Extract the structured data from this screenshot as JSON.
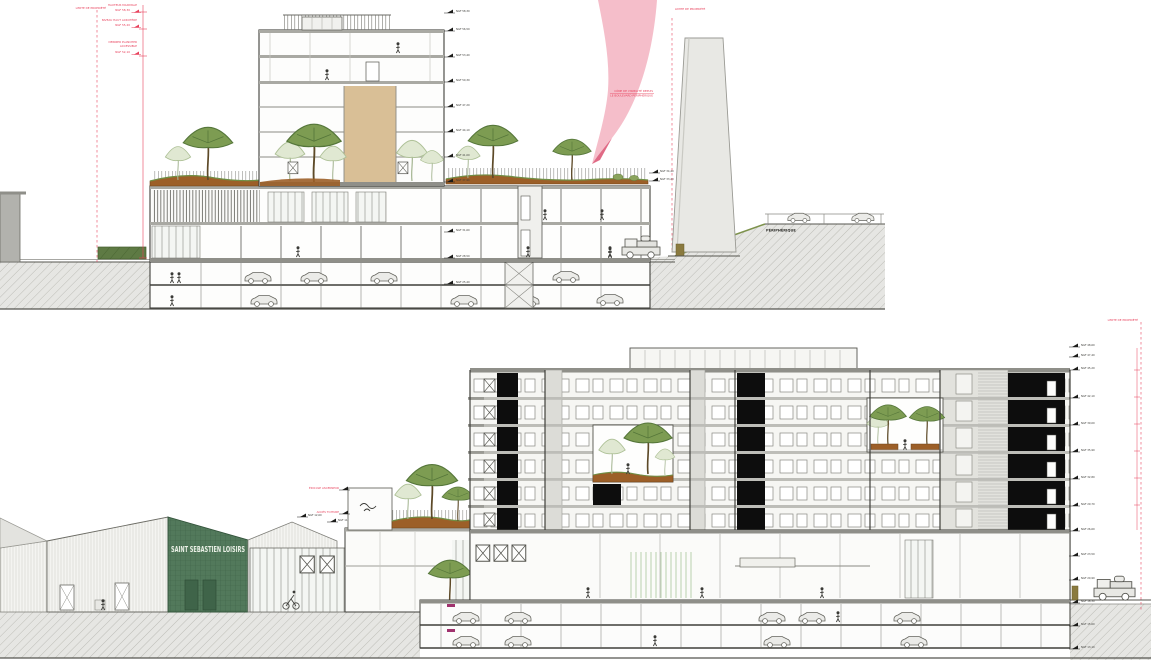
{
  "top": {
    "limit_left": "LIMITE DE PROPRIÉTÉ",
    "limit_right": "LIMITE DE PROPRIÉTÉ",
    "ann": [
      {
        "l1": "HAUTEUR MAXIMALE",
        "v": "NGF 58,30"
      },
      {
        "l1": "NIVEAU HAUT ACROTÈRE",
        "v": "NGF 55,20"
      },
      {
        "l1": "DERNIER PLANCHER",
        "l2": "ACCESSIBLE",
        "v": "NGF 52,10"
      }
    ],
    "ribbon1": "CÔNE DE VISIBILITÉ DEPUIS",
    "ribbon2": "LE BOULEVARD PÉRIPHÉRIQUE",
    "road": "PÉRIPHÉRIQUE",
    "levels": [
      "NGF 58,30",
      "NGF 56,50",
      "NGF 53,40",
      "NGF 50,30",
      "NGF 47,20",
      "NGF 44,10",
      "NGF 41,00",
      "NGF 37,90",
      "NGF 31,60",
      "NGF 28,50",
      "NGF 25,40"
    ],
    "roof_flags": [
      "NGF 34,40",
      "NGF 33,20"
    ]
  },
  "bottom": {
    "sign": "SAINT SEBASTIEN LOISIRS",
    "notes": [
      "ÉDICULE ASCENSEUR",
      "ACCÈS TOITURE"
    ],
    "shed_flags": [
      "NGF 12,60",
      "NGF 11,40"
    ],
    "levels": [
      "NGF 48,60",
      "NGF 47,40",
      "NGF 45,20",
      "NGF 42,10",
      "NGF 39,00",
      "NGF 35,90",
      "NGF 32,80",
      "NGF 29,70",
      "NGF 26,60",
      "NGF 23,50",
      "NGF 20,90",
      "NGF 18,30",
      "NGF 15,60",
      "NGF 13,10"
    ],
    "limit": "LIMITE DE PROPRIÉTÉ"
  },
  "colors": {
    "annotation_red": "#e8415c",
    "ribbon_pink": "#f4b8c5",
    "shed_green": "#50795a",
    "soil_brown": "#9c5f28",
    "tree_green": "#7a9a50",
    "panel_black": "#0d0d0d",
    "wall_tan": "#d9bf96"
  }
}
